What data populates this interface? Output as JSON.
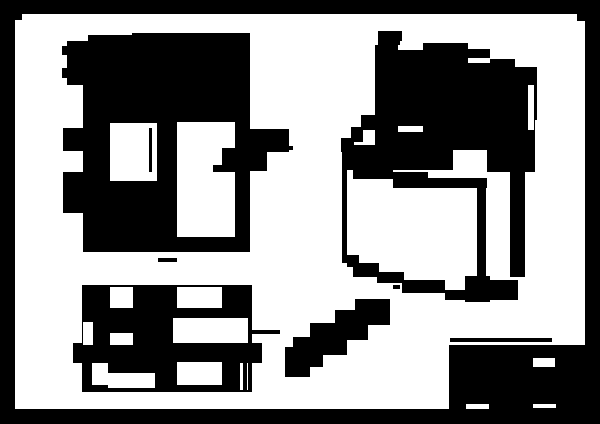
{
  "canvas": {
    "width": 600,
    "height": 424,
    "border_color": "#000000",
    "paper_color": "#ffffff",
    "ink_color": "#000000"
  },
  "sheet": {
    "shapes": [
      {
        "x": 15,
        "y": 14,
        "w": 570,
        "h": 395,
        "c": "paper"
      },
      {
        "x": 15,
        "y": 14,
        "w": 7,
        "h": 6,
        "c": "ink"
      },
      {
        "x": 577,
        "y": 14,
        "w": 8,
        "h": 7,
        "c": "ink"
      }
    ]
  },
  "front_view": {
    "shapes": [
      {
        "x": 67,
        "y": 41,
        "w": 21,
        "h": 44,
        "c": "ink"
      },
      {
        "x": 88,
        "y": 35,
        "w": 44,
        "h": 50,
        "c": "ink"
      },
      {
        "x": 132,
        "y": 33,
        "w": 118,
        "h": 52,
        "c": "ink"
      },
      {
        "x": 83,
        "y": 85,
        "w": 167,
        "h": 167,
        "c": "ink"
      },
      {
        "x": 62,
        "y": 46,
        "w": 5,
        "h": 9,
        "c": "ink"
      },
      {
        "x": 62,
        "y": 68,
        "w": 5,
        "h": 10,
        "c": "ink"
      },
      {
        "x": 63,
        "y": 128,
        "w": 20,
        "h": 23,
        "c": "ink"
      },
      {
        "x": 63,
        "y": 172,
        "w": 20,
        "h": 41,
        "c": "ink"
      },
      {
        "x": 249,
        "y": 129,
        "w": 40,
        "h": 21,
        "c": "ink"
      },
      {
        "x": 289,
        "y": 146,
        "w": 4,
        "h": 4,
        "c": "ink"
      },
      {
        "x": 267,
        "y": 150,
        "w": 22,
        "h": 2,
        "c": "ink"
      },
      {
        "x": 249,
        "y": 150,
        "w": 18,
        "h": 21,
        "c": "ink"
      },
      {
        "x": 110,
        "y": 123,
        "w": 47,
        "h": 58,
        "c": "paper"
      },
      {
        "x": 149,
        "y": 128,
        "w": 3,
        "h": 44,
        "c": "ink"
      },
      {
        "x": 177,
        "y": 122,
        "w": 58,
        "h": 115,
        "c": "paper"
      },
      {
        "x": 222,
        "y": 148,
        "w": 13,
        "h": 17,
        "c": "ink"
      },
      {
        "x": 213,
        "y": 165,
        "w": 22,
        "h": 7,
        "c": "ink"
      },
      {
        "x": 158,
        "y": 258,
        "w": 19,
        "h": 4,
        "c": "ink"
      }
    ]
  },
  "bottom_view": {
    "shapes": [
      {
        "x": 82,
        "y": 285,
        "w": 170,
        "h": 107,
        "c": "ink"
      },
      {
        "x": 73,
        "y": 343,
        "w": 9,
        "h": 20,
        "c": "ink"
      },
      {
        "x": 222,
        "y": 343,
        "w": 40,
        "h": 20,
        "c": "ink"
      },
      {
        "x": 240,
        "y": 337,
        "w": 12,
        "h": 7,
        "c": "ink"
      },
      {
        "x": 252,
        "y": 330,
        "w": 28,
        "h": 4,
        "c": "ink"
      },
      {
        "x": 110,
        "y": 287,
        "w": 23,
        "h": 21,
        "c": "paper"
      },
      {
        "x": 177,
        "y": 287,
        "w": 45,
        "h": 21,
        "c": "paper"
      },
      {
        "x": 83,
        "y": 322,
        "w": 10,
        "h": 23,
        "c": "paper"
      },
      {
        "x": 110,
        "y": 333,
        "w": 23,
        "h": 12,
        "c": "paper"
      },
      {
        "x": 173,
        "y": 318,
        "w": 75,
        "h": 25,
        "c": "paper"
      },
      {
        "x": 92,
        "y": 363,
        "w": 16,
        "h": 22,
        "c": "paper"
      },
      {
        "x": 108,
        "y": 373,
        "w": 47,
        "h": 15,
        "c": "paper"
      },
      {
        "x": 177,
        "y": 362,
        "w": 45,
        "h": 23,
        "c": "paper"
      },
      {
        "x": 240,
        "y": 363,
        "w": 8,
        "h": 27,
        "c": "paper"
      },
      {
        "x": 243,
        "y": 363,
        "w": 4,
        "h": 27,
        "c": "ink"
      }
    ]
  },
  "iso_view": {
    "shapes": [
      {
        "x": 378,
        "y": 31,
        "w": 24,
        "h": 14,
        "c": "ink"
      },
      {
        "x": 375,
        "y": 45,
        "w": 23,
        "h": 75,
        "c": "ink"
      },
      {
        "x": 423,
        "y": 43,
        "w": 45,
        "h": 7,
        "c": "ink"
      },
      {
        "x": 398,
        "y": 50,
        "w": 70,
        "h": 70,
        "c": "ink"
      },
      {
        "x": 468,
        "y": 49,
        "w": 22,
        "h": 9,
        "c": "ink"
      },
      {
        "x": 468,
        "y": 63,
        "w": 22,
        "h": 57,
        "c": "ink"
      },
      {
        "x": 490,
        "y": 59,
        "w": 25,
        "h": 61,
        "c": "ink"
      },
      {
        "x": 515,
        "y": 67,
        "w": 22,
        "h": 53,
        "c": "ink"
      },
      {
        "x": 375,
        "y": 120,
        "w": 160,
        "h": 30,
        "c": "ink"
      },
      {
        "x": 361,
        "y": 115,
        "w": 16,
        "h": 15,
        "c": "ink"
      },
      {
        "x": 351,
        "y": 127,
        "w": 12,
        "h": 15,
        "c": "ink"
      },
      {
        "x": 341,
        "y": 138,
        "w": 13,
        "h": 14,
        "c": "ink"
      },
      {
        "x": 342,
        "y": 145,
        "w": 193,
        "h": 27,
        "c": "ink"
      },
      {
        "x": 510,
        "y": 150,
        "w": 15,
        "h": 127,
        "c": "ink"
      },
      {
        "x": 400,
        "y": 41,
        "w": 23,
        "h": 8,
        "c": "paper"
      },
      {
        "x": 468,
        "y": 58,
        "w": 22,
        "h": 5,
        "c": "paper"
      },
      {
        "x": 398,
        "y": 126,
        "w": 25,
        "h": 6,
        "c": "paper"
      },
      {
        "x": 528,
        "y": 85,
        "w": 6,
        "h": 45,
        "c": "paper"
      },
      {
        "x": 347,
        "y": 170,
        "w": 130,
        "h": 98,
        "c": "paper"
      },
      {
        "x": 486,
        "y": 193,
        "w": 24,
        "h": 87,
        "c": "paper"
      },
      {
        "x": 453,
        "y": 150,
        "w": 34,
        "h": 30,
        "c": "paper"
      },
      {
        "x": 353,
        "y": 168,
        "w": 40,
        "h": 11,
        "c": "ink"
      },
      {
        "x": 393,
        "y": 172,
        "w": 35,
        "h": 16,
        "c": "ink"
      },
      {
        "x": 425,
        "y": 178,
        "w": 62,
        "h": 10,
        "c": "ink"
      },
      {
        "x": 342,
        "y": 168,
        "w": 5,
        "h": 95,
        "c": "ink"
      },
      {
        "x": 477,
        "y": 180,
        "w": 9,
        "h": 122,
        "c": "ink"
      },
      {
        "x": 347,
        "y": 255,
        "w": 12,
        "h": 12,
        "c": "ink"
      },
      {
        "x": 353,
        "y": 263,
        "w": 26,
        "h": 14,
        "c": "ink"
      },
      {
        "x": 377,
        "y": 272,
        "w": 27,
        "h": 11,
        "c": "ink"
      },
      {
        "x": 402,
        "y": 280,
        "w": 43,
        "h": 13,
        "c": "ink"
      },
      {
        "x": 445,
        "y": 290,
        "w": 30,
        "h": 10,
        "c": "ink"
      },
      {
        "x": 465,
        "y": 276,
        "w": 25,
        "h": 26,
        "c": "ink"
      },
      {
        "x": 490,
        "y": 280,
        "w": 28,
        "h": 20,
        "c": "ink"
      }
    ]
  },
  "pointer_mark": {
    "shapes": [
      {
        "x": 393,
        "y": 285,
        "w": 7,
        "h": 4,
        "c": "ink"
      },
      {
        "x": 355,
        "y": 299,
        "w": 35,
        "h": 26,
        "c": "ink"
      },
      {
        "x": 335,
        "y": 310,
        "w": 33,
        "h": 30,
        "c": "ink"
      },
      {
        "x": 310,
        "y": 323,
        "w": 37,
        "h": 32,
        "c": "ink"
      },
      {
        "x": 293,
        "y": 337,
        "w": 30,
        "h": 30,
        "c": "ink"
      },
      {
        "x": 285,
        "y": 347,
        "w": 25,
        "h": 30,
        "c": "ink"
      }
    ]
  },
  "title_block": {
    "shapes": [
      {
        "x": 450,
        "y": 338,
        "w": 102,
        "h": 4,
        "c": "ink"
      },
      {
        "x": 449,
        "y": 345,
        "w": 151,
        "h": 79,
        "c": "ink"
      },
      {
        "x": 533,
        "y": 358,
        "w": 22,
        "h": 9,
        "c": "paper"
      },
      {
        "x": 466,
        "y": 404,
        "w": 23,
        "h": 5,
        "c": "paper"
      },
      {
        "x": 533,
        "y": 404,
        "w": 23,
        "h": 4,
        "c": "paper"
      }
    ]
  }
}
